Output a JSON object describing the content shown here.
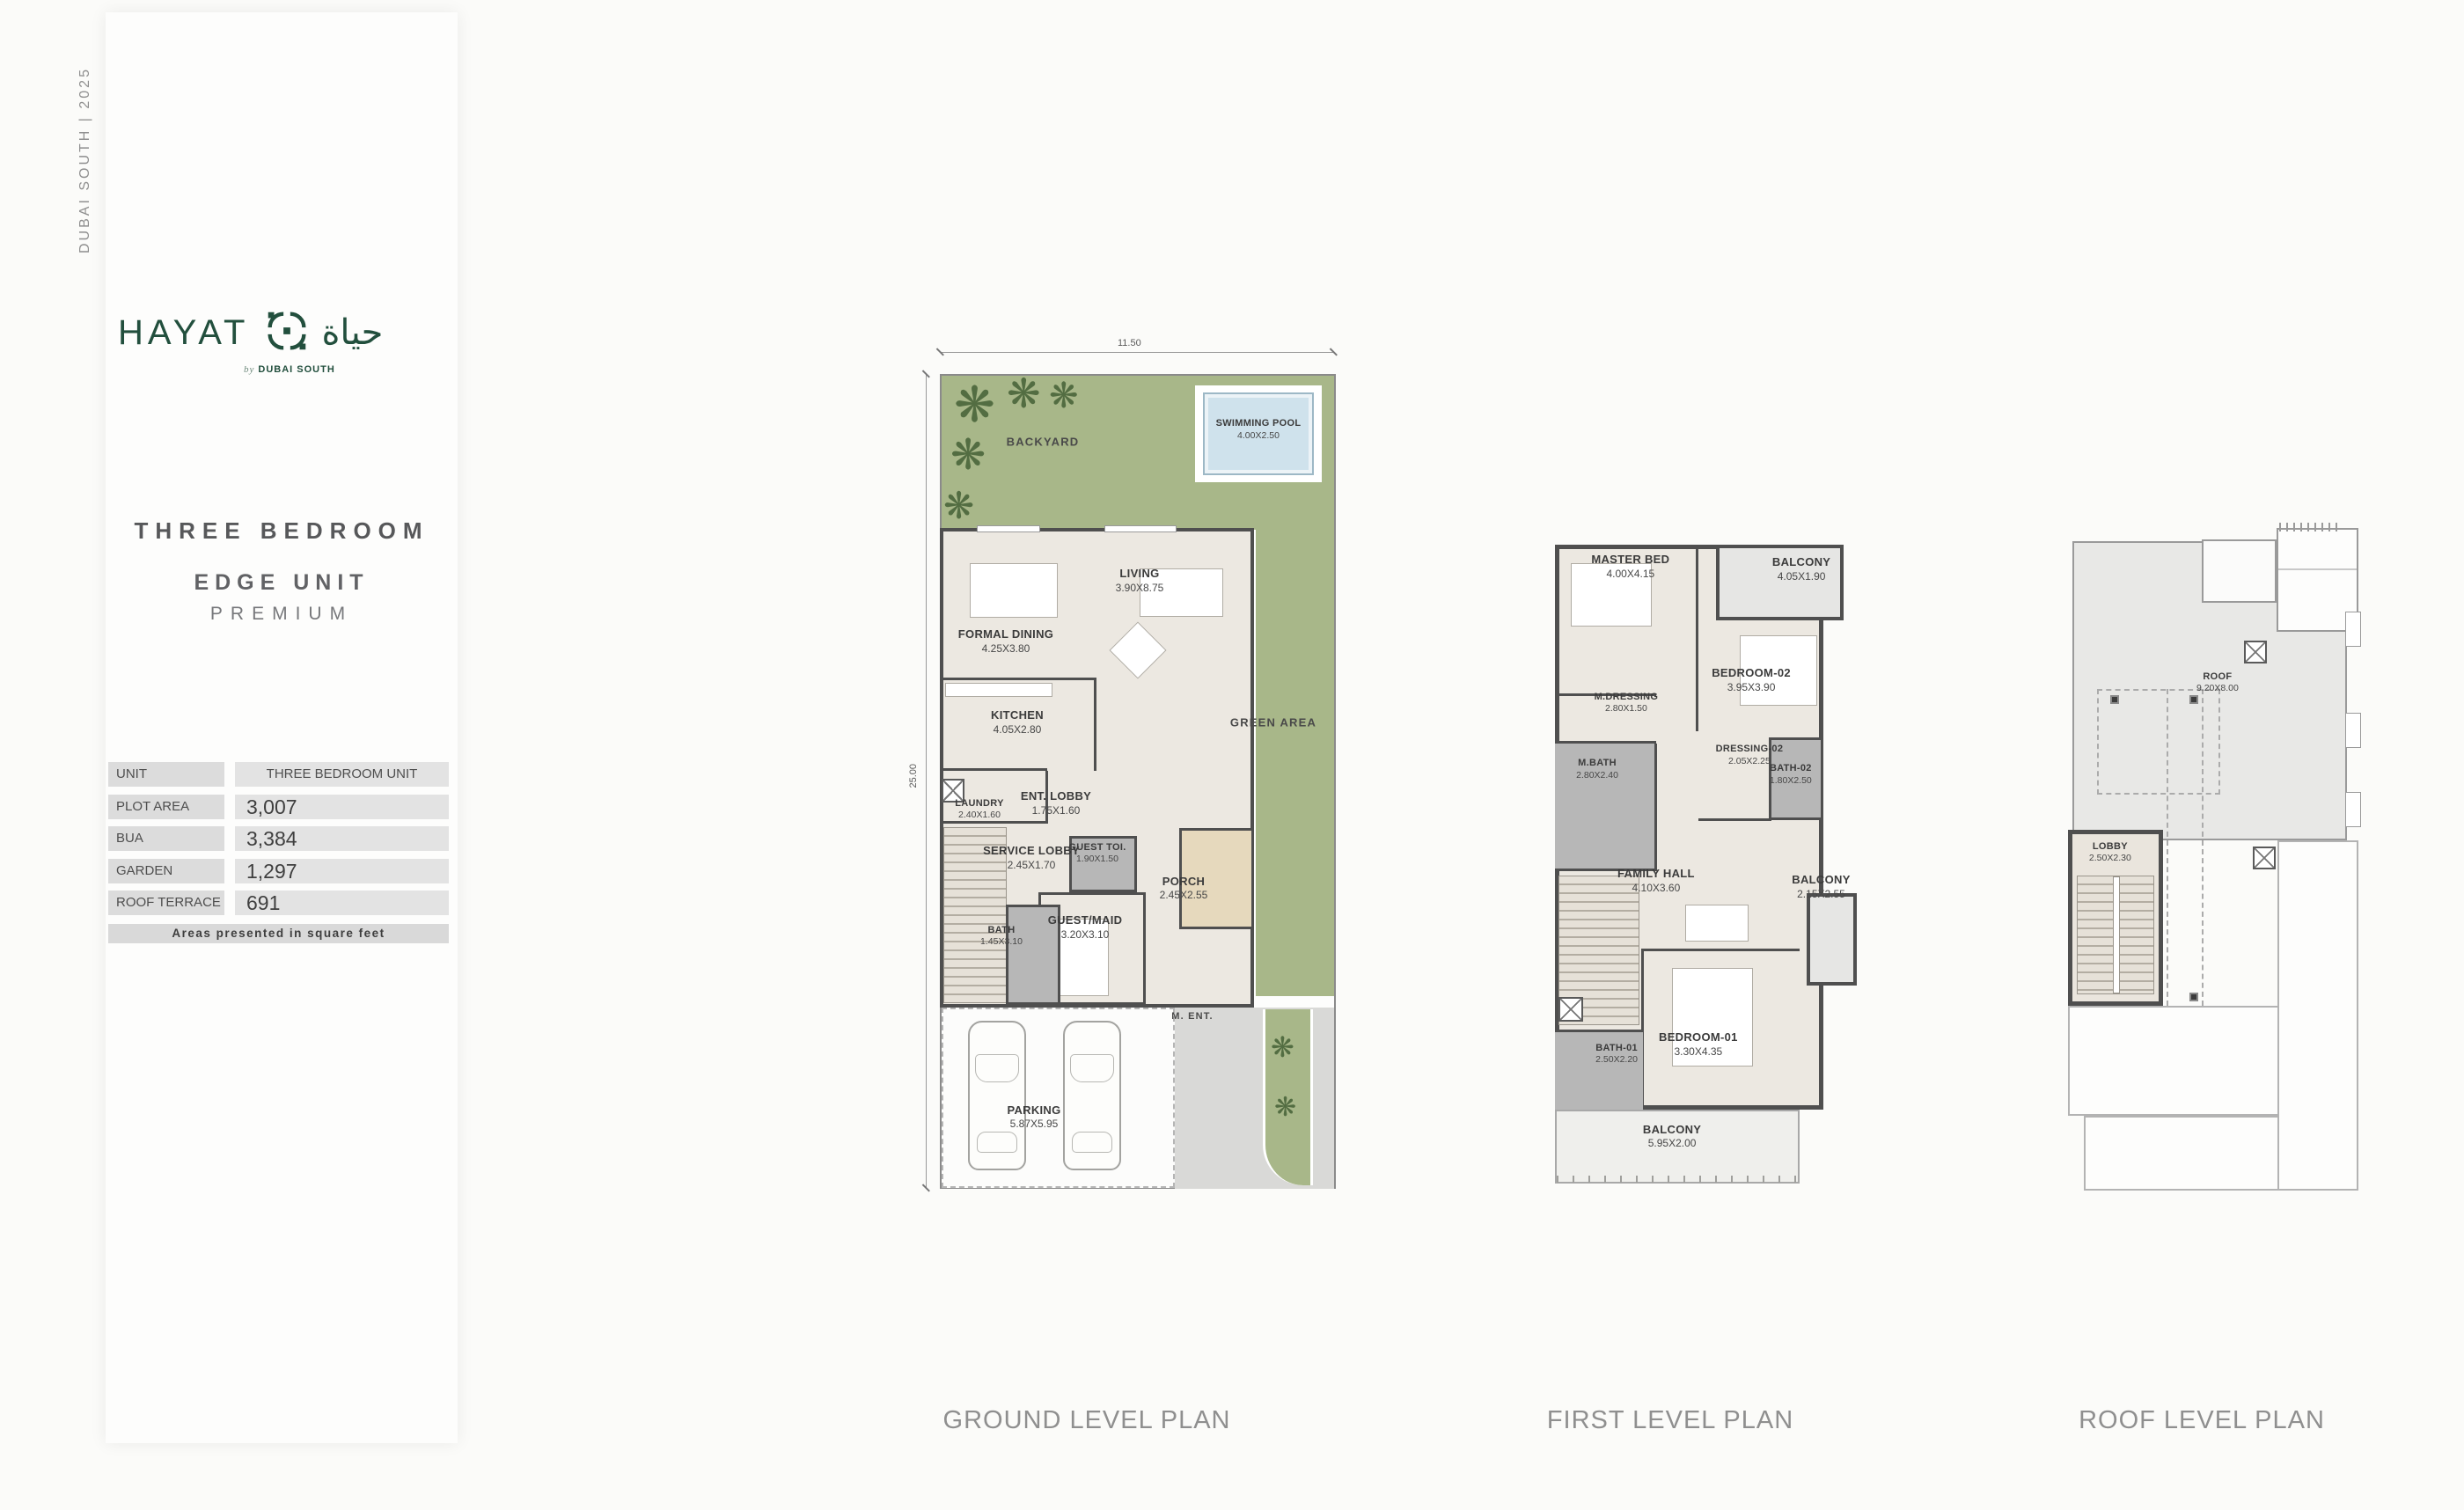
{
  "page": {
    "background": "#fbfbf9"
  },
  "icons": {
    "tree_glyph": "❋"
  },
  "sidebar": {
    "vertical_text": "DUBAI SOUTH   |   2025",
    "logo": {
      "wordmark": "HAYAT",
      "arabic": "حياة",
      "byline_prefix": "by",
      "byline": "DUBAI SOUTH",
      "brand_color": "#224f3d"
    },
    "heading": "THREE BEDROOM",
    "subheading": "EDGE UNIT",
    "tier": "PREMIUM",
    "table": {
      "rows": [
        {
          "label": "UNIT",
          "value": "THREE BEDROOM UNIT",
          "kind": "txt"
        },
        {
          "label": "PLOT AREA",
          "value": "3,007",
          "kind": "num"
        },
        {
          "label": "BUA",
          "value": "3,384",
          "kind": "num"
        },
        {
          "label": "GARDEN",
          "value": "1,297",
          "kind": "num"
        },
        {
          "label": "ROOF TERRACE",
          "value": "691",
          "kind": "num"
        }
      ],
      "footnote": "Areas presented in square feet"
    }
  },
  "plans": {
    "ground": {
      "title": "GROUND LEVEL PLAN",
      "dim_top": "11.50",
      "dim_left": "25.00",
      "rooms": [
        {
          "label": "BACKYARD",
          "x": 29,
          "y": 11.7,
          "single": true,
          "area": true
        },
        {
          "label": "SWIMMING POOL",
          "dims": "4.00X2.50",
          "x": 78,
          "y": 10.2,
          "small": true
        },
        {
          "label": "LIVING",
          "dims": "3.90X8.75",
          "x": 51,
          "y": 27.6
        },
        {
          "label": "FORMAL DINING",
          "dims": "4.25X3.80",
          "x": 20.6,
          "y": 34.6
        },
        {
          "label": "KITCHEN",
          "dims": "4.05X2.80",
          "x": 23.2,
          "y": 44.0
        },
        {
          "label": "GREEN AREA",
          "x": 81.4,
          "y": 44.1,
          "single": true,
          "area": true
        },
        {
          "label": "LAUNDRY",
          "dims": "2.40X1.60",
          "x": 14.6,
          "y": 54.0,
          "small": true
        },
        {
          "label": "ENT. LOBBY",
          "dims": "1.75X1.60",
          "x": 32,
          "y": 53.3
        },
        {
          "label": "SERVICE LOBBY",
          "dims": "2.45X1.70",
          "x": 26.4,
          "y": 59.6
        },
        {
          "label": "GUEST TOI.",
          "dims": "1.90X1.50",
          "x": 41.4,
          "y": 59.1,
          "small": true
        },
        {
          "label": "PORCH",
          "dims": "2.45X2.55",
          "x": 61,
          "y": 63.1
        },
        {
          "label": "BATH",
          "dims": "1.45X3.10",
          "x": 19.6,
          "y": 68.6,
          "small": true
        },
        {
          "label": "GUEST/MAID",
          "dims": "3.20X3.10",
          "x": 38.6,
          "y": 67.6
        },
        {
          "label": "M. ENT.",
          "x": 63,
          "y": 77.9,
          "single": true,
          "small": true,
          "area": true
        },
        {
          "label": "PARKING",
          "dims": "5.87X5.95",
          "x": 27,
          "y": 89.5
        }
      ]
    },
    "first": {
      "title": "FIRST LEVEL PLAN",
      "rooms": [
        {
          "label": "MASTER BED",
          "dims": "4.00X4.15",
          "x": 25.1,
          "y": 5.8
        },
        {
          "label": "BALCONY",
          "dims": "4.05X1.90",
          "x": 80.6,
          "y": 6.2
        },
        {
          "label": "BEDROOM-02",
          "dims": "3.95X3.90",
          "x": 64.3,
          "y": 22.8
        },
        {
          "label": "M.DRESSING",
          "dims": "2.80X1.50",
          "x": 23.7,
          "y": 26.2,
          "small": true
        },
        {
          "label": "M.BATH",
          "dims": "2.80X2.40",
          "x": 14.3,
          "y": 36.1,
          "small": true
        },
        {
          "label": "DRESSING-02",
          "dims": "2.05X2.25",
          "x": 63.7,
          "y": 34.0,
          "small": true
        },
        {
          "label": "BATH-02",
          "dims": "1.80X2.50",
          "x": 77.1,
          "y": 36.9,
          "small": true
        },
        {
          "label": "FAMILY HALL",
          "dims": "4.10X3.60",
          "x": 33.4,
          "y": 52.8
        },
        {
          "label": "BALCONY",
          "dims": "2.15X2.55",
          "x": 87,
          "y": 53.7
        },
        {
          "label": "BEDROOM-01",
          "dims": "3.30X4.35",
          "x": 47.1,
          "y": 77.2
        },
        {
          "label": "BATH-01",
          "dims": "2.50X2.20",
          "x": 20.6,
          "y": 78.7,
          "small": true
        },
        {
          "label": "BALCONY",
          "dims": "5.95X2.00",
          "x": 38.6,
          "y": 91.0
        }
      ]
    },
    "roof": {
      "title": "ROOF LEVEL PLAN",
      "rooms": [
        {
          "label": "ROOF",
          "dims": "9.20X8.00",
          "x": 47.2,
          "y": 23.1,
          "small": true
        },
        {
          "label": "LOBBY",
          "dims": "2.50X2.30",
          "x": 13.3,
          "y": 48.5,
          "small": true
        }
      ]
    }
  }
}
